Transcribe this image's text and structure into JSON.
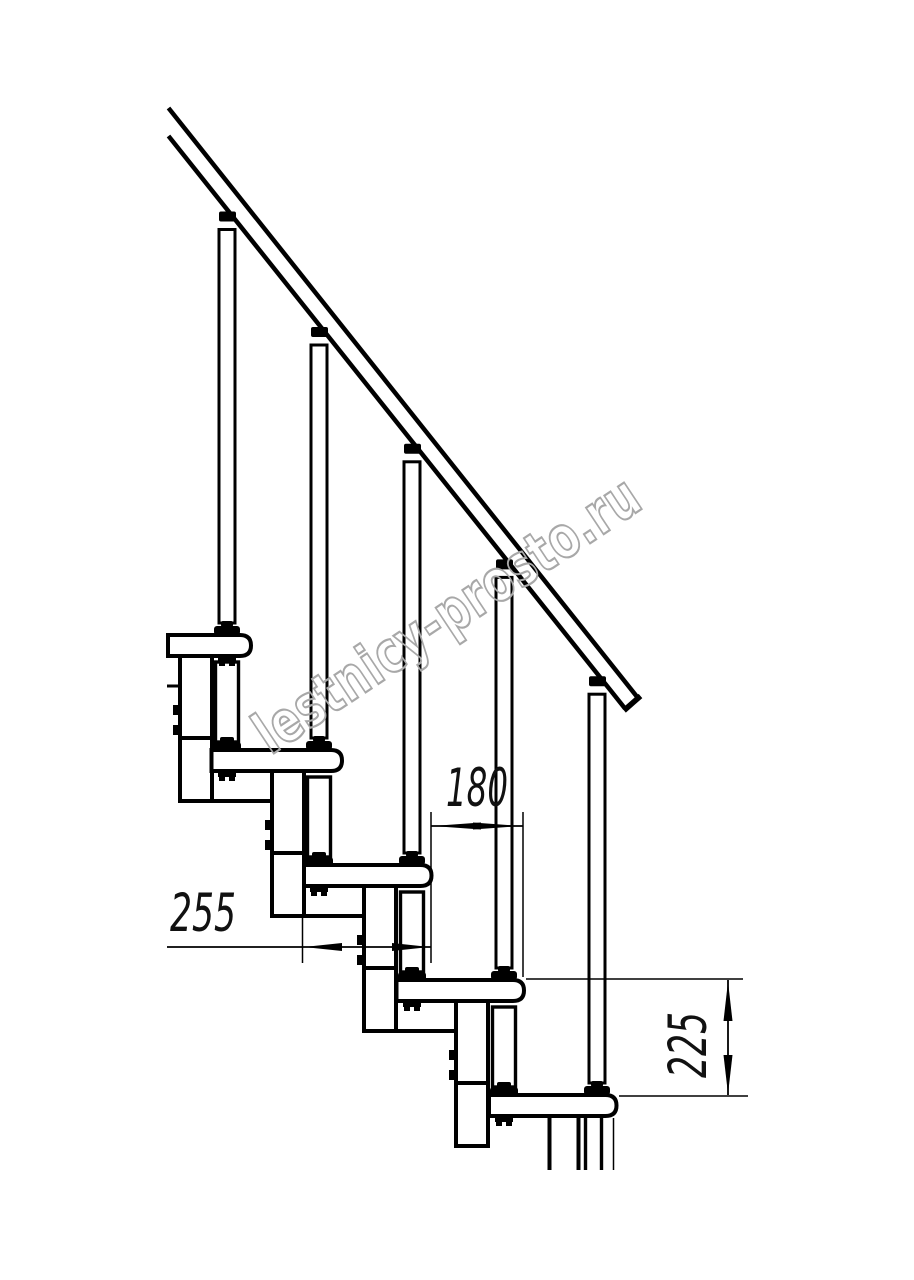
{
  "watermark": {
    "text": "lestnicy-prosto.ru"
  },
  "dimensions": {
    "step_depth": "255",
    "step_offset": "180",
    "step_rise": "225"
  }
}
